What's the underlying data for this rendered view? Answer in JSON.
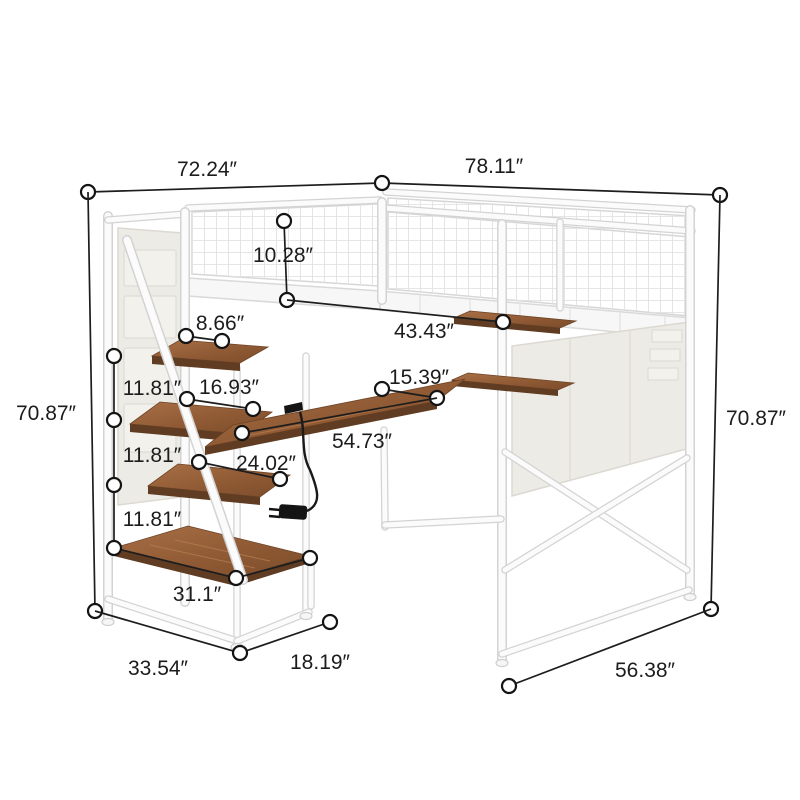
{
  "title": "Loft bed with staircase storage, desk and shelves — dimension diagram",
  "unit": "inches",
  "dimensions": {
    "overall_depth_top": "72.24″",
    "overall_width_top": "78.11″",
    "overall_height_left": "70.87″",
    "overall_height_right": "70.87″",
    "guardrail_height": "10.28″",
    "top_step_depth": "8.66″",
    "under_bed_width": "43.43″",
    "step_spacing_1": "11.81″",
    "step_spacing_2": "11.81″",
    "step_spacing_3": "11.81″",
    "step_length": "16.93″",
    "side_shelf_length": "15.39″",
    "desk_length": "54.73″",
    "lower_step_length": "24.02″",
    "bottom_shelf_length": "31.1″",
    "staircase_depth": "33.54″",
    "staircase_width": "18.19″",
    "base_depth_right": "56.38″"
  }
}
